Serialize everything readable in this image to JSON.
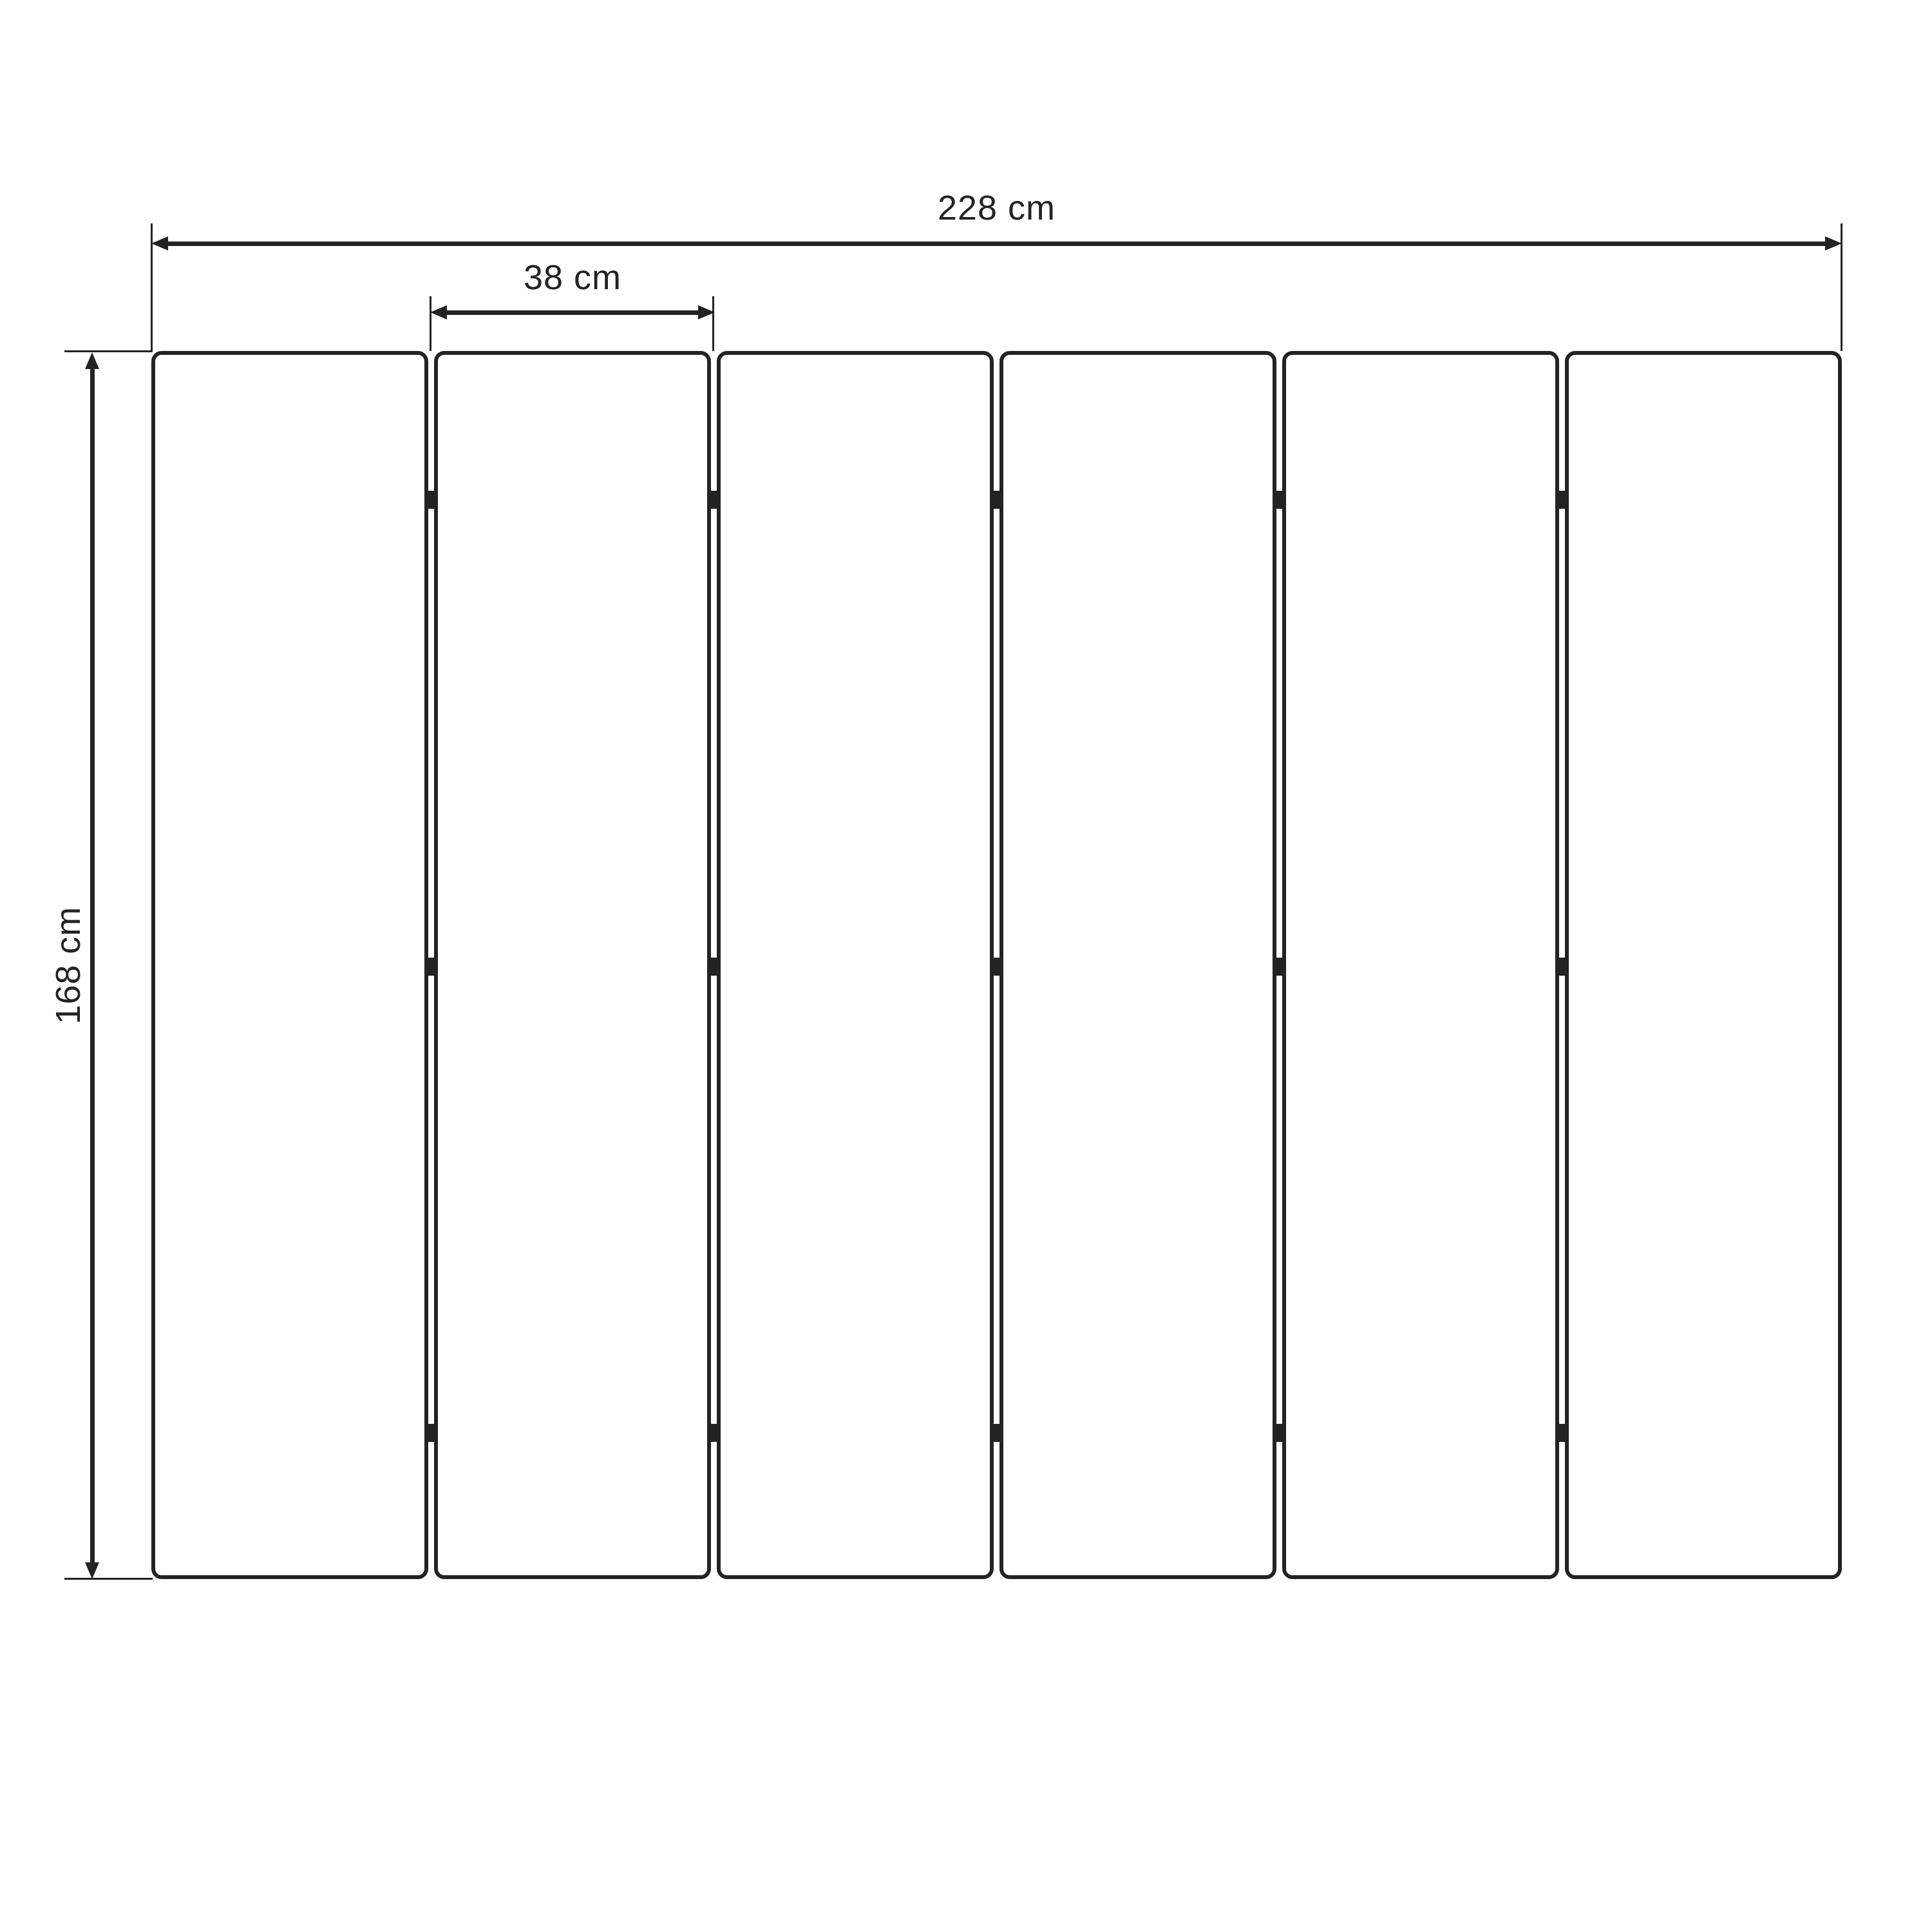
{
  "diagram": {
    "background_color": "#ffffff",
    "line_color": "#232323",
    "panels": {
      "count": 6,
      "connector_rows_per_joint": 3
    },
    "dimensions": {
      "total_width": {
        "label": "228 cm"
      },
      "panel_width": {
        "label": "38 cm"
      },
      "height": {
        "label": "168 cm"
      }
    }
  }
}
